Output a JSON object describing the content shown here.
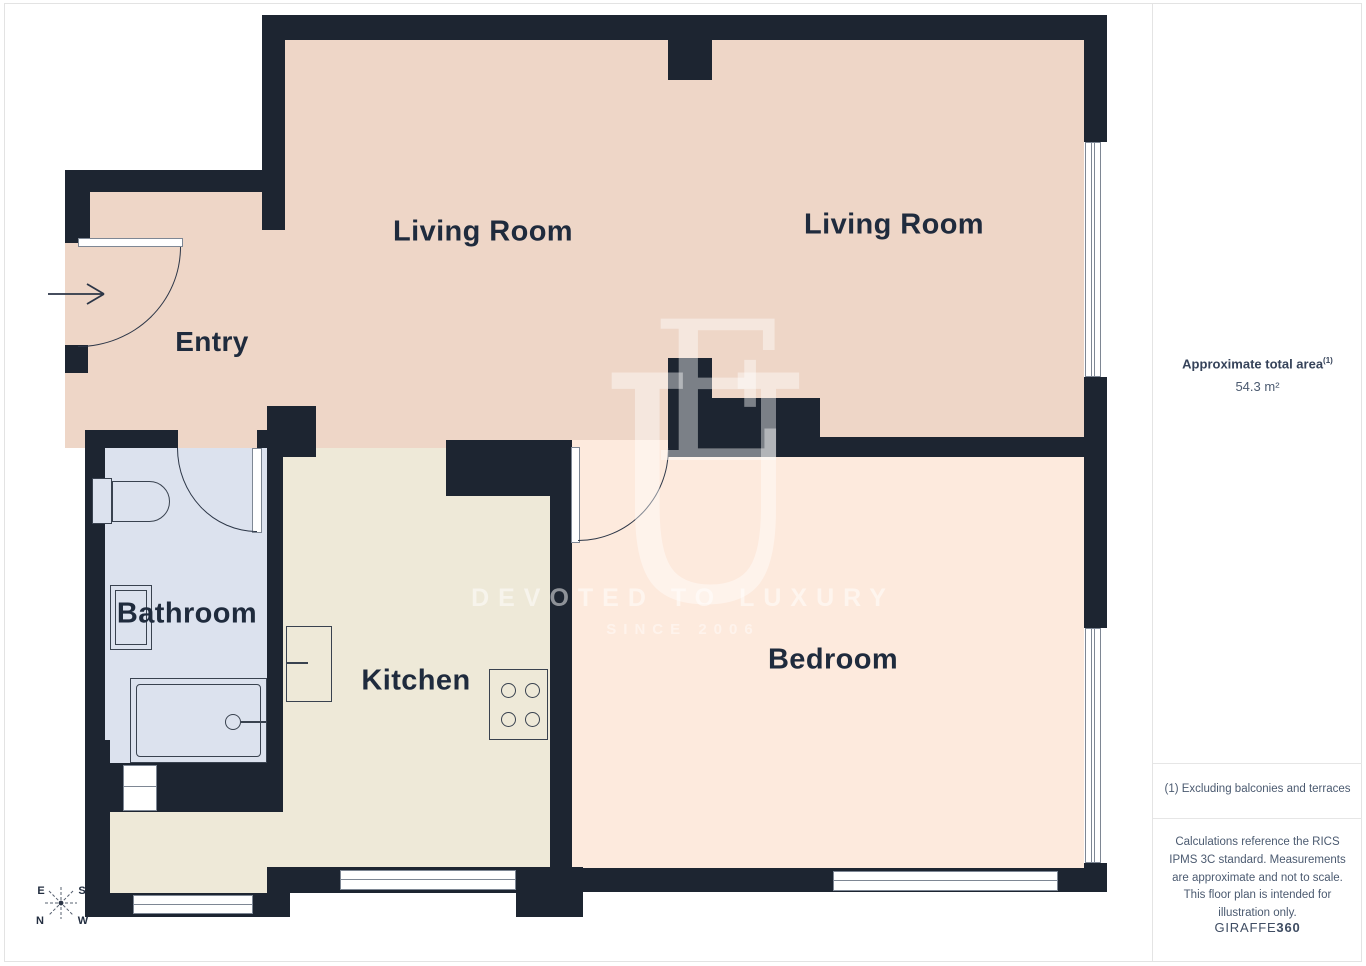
{
  "plan": {
    "labels": {
      "living_room_left": "Living Room",
      "living_room_right": "Living Room",
      "entry": "Entry",
      "bathroom": "Bathroom",
      "kitchen": "Kitchen",
      "bedroom": "Bedroom"
    },
    "compass": {
      "top_left": "E",
      "top_right": "S",
      "bottom_left": "N",
      "bottom_right": "W"
    },
    "watermark": {
      "letter_u": "U",
      "letter_e": "E",
      "tagline": "DEVOTED TO LUXURY",
      "since": "SINCE 2006"
    },
    "colors": {
      "wall": "#1d2531",
      "living_floor": "#eed6c7",
      "bathroom_floor": "#dce2ee",
      "kitchen_floor": "#eee9d8",
      "bedroom_floor": "#fdeadd"
    }
  },
  "sidebar": {
    "area_label": "Approximate total area",
    "area_footnote_marker": "(1)",
    "area_value": "54.3 m²",
    "footnote": "(1) Excluding balconies and terraces",
    "disclaimer": "Calculations reference the RICS IPMS 3C standard. Measurements are approximate and not to scale. This floor plan is intended for illustration only.",
    "brand": {
      "name": "GIRAFFE",
      "suffix": "360"
    }
  }
}
